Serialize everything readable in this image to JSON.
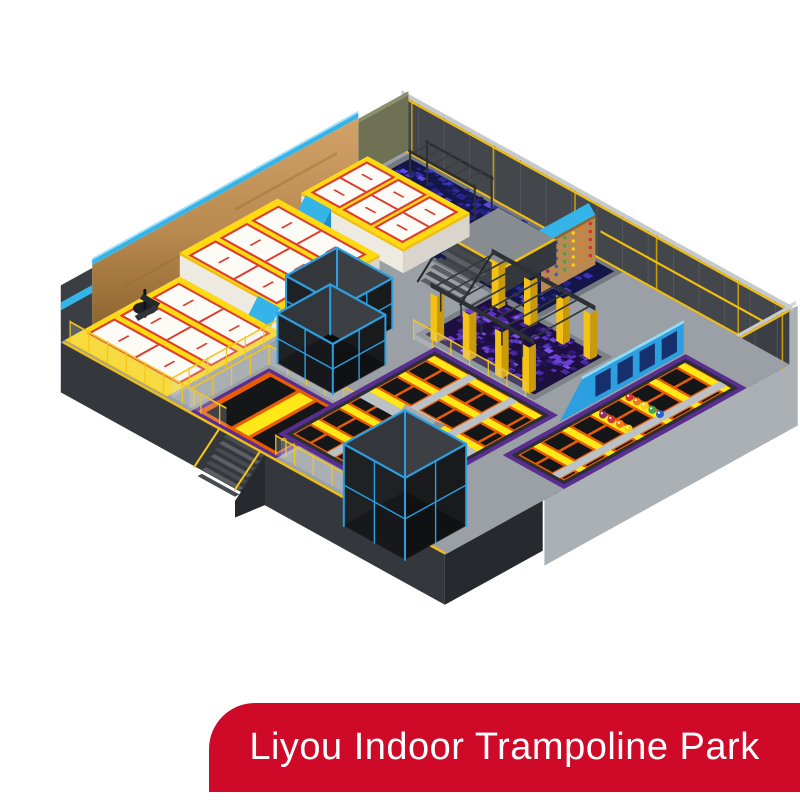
{
  "banner": {
    "label": "Liyou Indoor Trampoline Park",
    "background": "#ce0a28",
    "text_color": "#ffffff"
  },
  "scene": {
    "background": "#ffffff",
    "description": "isometric 3d render of an indoor trampoline park floor plan",
    "palette": {
      "floor": "#9aa0a5",
      "wall_dark": "#43474b",
      "wall_panel": "#53575c",
      "wall_cap": "#c7cacc",
      "wall_outer": "#abb0b5",
      "front_face": "#34383c",
      "front_face_dark": "#26292d",
      "olive": "#6f7154",
      "wood": "#bb8a50",
      "wood_dark": "#8f6530",
      "cyan": "#35b4ea",
      "cyan_light": "#8fdcf8",
      "yellow": "#ffd912",
      "yellow_deep": "#f0bd10",
      "white_face": "#edeae2",
      "court_white": "#fdfbf6",
      "court_red": "#de3a2e",
      "purple": "#5a2d91",
      "orange": "#e85d04",
      "trampoline_black": "#141618",
      "lane_yellow": "#ffe817",
      "runway_gray": "#bcc1c5",
      "blue_frame": "#2b9fe0",
      "navy_panel": "#16306e",
      "steel": "#2c2f33",
      "ballpit_base": "#14164a",
      "foam_base": "#1d1040",
      "column_yellow": "#f4c115"
    },
    "ballpit_cube_colors": [
      "#2a2d9c",
      "#3b31bb",
      "#21247c",
      "#4a3ccf",
      "#191c62",
      "#5a49e0",
      "#2f1f8e"
    ],
    "foam_cube_colors": [
      "#4a2b9e",
      "#5a35c0",
      "#3a1f85",
      "#6b40d6",
      "#2e1766",
      "#7c52e8",
      "#241356"
    ],
    "ball_colors": [
      "#d6342c",
      "#f07818",
      "#f2cf1d",
      "#46a24a",
      "#2b62c9",
      "#8c2f6f"
    ]
  }
}
